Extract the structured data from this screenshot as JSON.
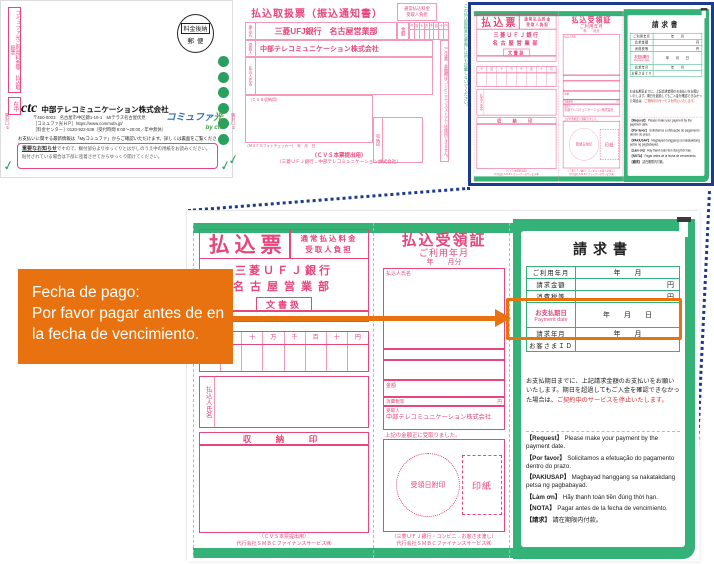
{
  "colors": {
    "slip_pink": "#e8457a",
    "green": "#35b277",
    "frame_blue": "#1c3b8f",
    "annotation_orange": "#e8720f"
  },
  "envelope": {
    "side_label": "コミュファ光ご利用料金等　払込取扱票",
    "side_label_2": "在中",
    "postmark_top": "料金後納",
    "postmark_bottom": "郵便",
    "logo": "ctc",
    "company": "中部テレコミュニケーション株式会社",
    "address": "〒460-0003　名古屋市中区錦1-10-1　MIテラス名古屋伏見",
    "website": "［コミュファ光ＨＰ］https://www.commufa.jp/",
    "phone": "［料金センター］0120-922-538（受付時間 9:00〜20:00／年中無休）",
    "brand_1": "コミュファ",
    "brand_2": "光",
    "brand_by": "by ctc",
    "notice": "お支払いに関する最新情報は「Myコミュファ」からご確認いただけます。詳しくは裏面をご覧ください。",
    "important_title": "重要なお知らせ",
    "important_text": "ですので、糊付部分よりゆっくりとはがしのうえ中の用紙をお読みください。",
    "important_text2": "貼付されている場合は下部に密着させてからゆっくり開けてください。",
    "open_left": "開封口①",
    "open_right": "開封口②"
  },
  "transfer_slip": {
    "title": "払込取扱票（振込通知書）",
    "fee_line1": "通常払込料金",
    "fee_line2": "受取人負担",
    "bank_label": "振込先",
    "bank": "三菱UFJ銀行　名古屋営業部",
    "amount_label": "金額",
    "payee_label": "受取人",
    "payee": "中部テレコミュニケーション株式会社",
    "payer_label": "払込人氏名",
    "cvs_label": "（ＣＶＳ収納用）",
    "stamp_label": "収納印",
    "ocr_line": "（ＭＵＦＧフォトチェッカー）　年　月　日",
    "footer1": "（ＣＶＳ本票提出用）",
    "footer2": "（三菱ＵＦＪ銀行→中部テレコミュニケーション株式会社）",
    "caution": "（ご注意）金額欄はコンビニエンスストアでは使用できません。",
    "back_note": "この払込取扱票の裏面には何も記載しないでください。"
  },
  "slip": {
    "col1": {
      "title": "払込票",
      "fee_line1": "通常払込料金",
      "fee_line2": "受取人負担",
      "bank_line1": "三菱ＵＦＪ銀行",
      "bank_line2": "名古屋営業部",
      "doc_tag": "文書扱",
      "digits": [
        "千",
        "百",
        "十",
        "万",
        "千",
        "百",
        "十",
        "円"
      ],
      "payer_label": "払込人氏名",
      "stamp_header": "収　納　印",
      "footer1": "（ＣＶＳ本票提出用）",
      "footer2": "代行会社ＳＭＢＣファイナンスサービス㈱"
    },
    "col2": {
      "title": "払込受領証",
      "subtitle": "ご利用年月",
      "ym": "年　　月分",
      "payer_label": "払込人氏名",
      "amount_label": "金額",
      "tax_label": "消費税等",
      "yen": "円",
      "recipient_label": "受取人",
      "recipient": "中部テレコミュニケーション株式会社",
      "received_note": "上記の金額正に受取りました。",
      "date_stamp": "受領日附印",
      "revenue_stamp": "印紙",
      "footer1": "（三菱ＵＦＪ銀行・コンビニ→お客さま渡し）",
      "footer2": "代行会社ＳＭＢＣファイナンスサービス㈱"
    },
    "col3": {
      "title": "請求書",
      "rows": [
        {
          "label": "ご利用年月",
          "value": "年　　月"
        },
        {
          "label": "請求金額",
          "value": "円"
        },
        {
          "label": "消費税等",
          "value": "円"
        },
        {
          "label": "お支払期日",
          "label_en": "Payment date",
          "value": "年　　月　　日"
        },
        {
          "label": "請求年月",
          "value": "年　　月"
        },
        {
          "label": "お客さまＩＤ",
          "value": ""
        }
      ],
      "note": "お支払期日までに、上記請求金額のお支払いをお願いいたします。期日を超過してもご入金を確認できなかった場合は、",
      "note_red": "ご契約中のサービスを停止いたします。",
      "multilingual": [
        {
          "tag": "【Request】",
          "text": "Please make your payment by the payment date."
        },
        {
          "tag": "【Por favor】",
          "text": "Solicitamos a efetuação do pagamento dentro do prazo."
        },
        {
          "tag": "【PAKIUSAP】",
          "text": "Magbayad hanggang sa nakatakdang petsa ng pagbabayad."
        },
        {
          "tag": "【Làm ơn】",
          "text": "Hãy thanh toán tiền đúng thời hạn."
        },
        {
          "tag": "【NOTA】",
          "text": "Pagar antes de la fecha de vencimiento."
        },
        {
          "tag": "【請求】",
          "text": "請在期限内付款。"
        }
      ]
    }
  },
  "callout": {
    "line1": "Fecha de pago:",
    "line2": "Por favor pagar antes de en",
    "line3": "la fecha de vencimiento."
  }
}
